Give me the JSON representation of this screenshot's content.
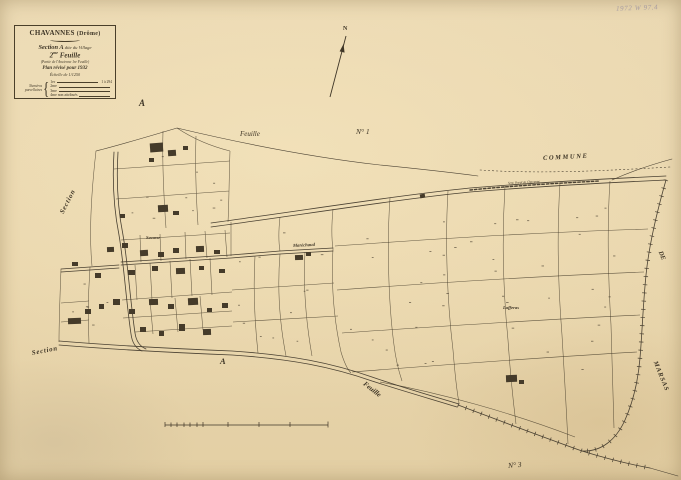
{
  "title_block": {
    "commune": "CHAVANNES",
    "departement": "(Drôme)",
    "section_bold": "Section A",
    "section_rest": "dite du Village",
    "feuille_num": "2",
    "feuille_sup": "me",
    "feuille_word": "Feuille",
    "ancienne": "(Partie de l'Ancienne 1re Feuille)",
    "revision": "Plan révisé pour 1932",
    "echelle": "Échelle de 1/1250",
    "legend_title_1": "Numéros",
    "legend_title_2": "parcellaires",
    "legend_brace": "{",
    "legend_rows": [
      {
        "label": "1er",
        "note": ""
      },
      {
        "label": "2me",
        "note": ""
      },
      {
        "label": "3me",
        "note": ""
      },
      {
        "label": "4me",
        "note": "non attribués"
      }
    ],
    "legend_range": "1 à 294"
  },
  "compass": {
    "north": "N"
  },
  "archive_note": "1972 W 97.4",
  "labels": {
    "feuille_top": "Feuille",
    "no1": "N° 1",
    "commune": "COMMUNE",
    "de": "DE",
    "marsas": "MARSAS",
    "section_upper": "Section",
    "a_upper": "A",
    "section_lower": "Section",
    "a_lower": "A",
    "savasse": "Savasse",
    "marechaud": "Maréchaud",
    "lafferas": "Lafferas",
    "feuille_bottom": "Feuille",
    "no3": "N° 3",
    "road": "Sent. Rural de Chavanne"
  },
  "colors": {
    "paper": "#e9d6ad",
    "ink": "#453c2b"
  }
}
